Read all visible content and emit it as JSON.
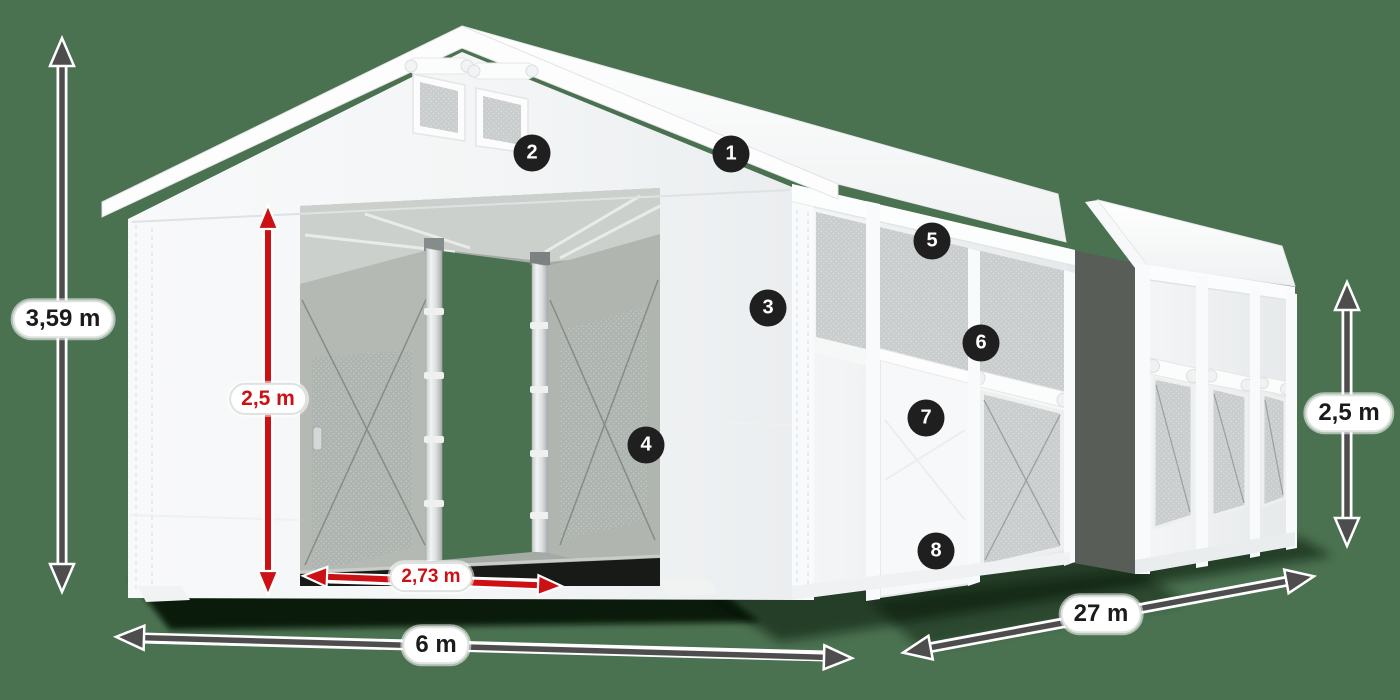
{
  "dimension_labels": {
    "total_height": "3,59 m",
    "entrance_height": "2,5 m",
    "entrance_width": "2,73 m",
    "front_width": "6 m",
    "length": "27 m",
    "side_height": "2,5 m"
  },
  "callouts": [
    {
      "number": "1"
    },
    {
      "number": "2"
    },
    {
      "number": "3"
    },
    {
      "number": "4"
    },
    {
      "number": "5"
    },
    {
      "number": "6"
    },
    {
      "number": "7"
    },
    {
      "number": "8"
    }
  ],
  "colors": {
    "background": "#4a7150",
    "dimension_arrow_dark": "#4d4d4d",
    "dimension_arrow_red": "#cc1115",
    "label_background": "#ffffff",
    "label_text_dark": "#1b1b1b",
    "label_text_red": "#cc1115",
    "callout_background": "#1f1f1f",
    "callout_text": "#ffffff",
    "tent_fabric": "#f6f8f9",
    "mesh_gray": "#c9cdcd"
  }
}
